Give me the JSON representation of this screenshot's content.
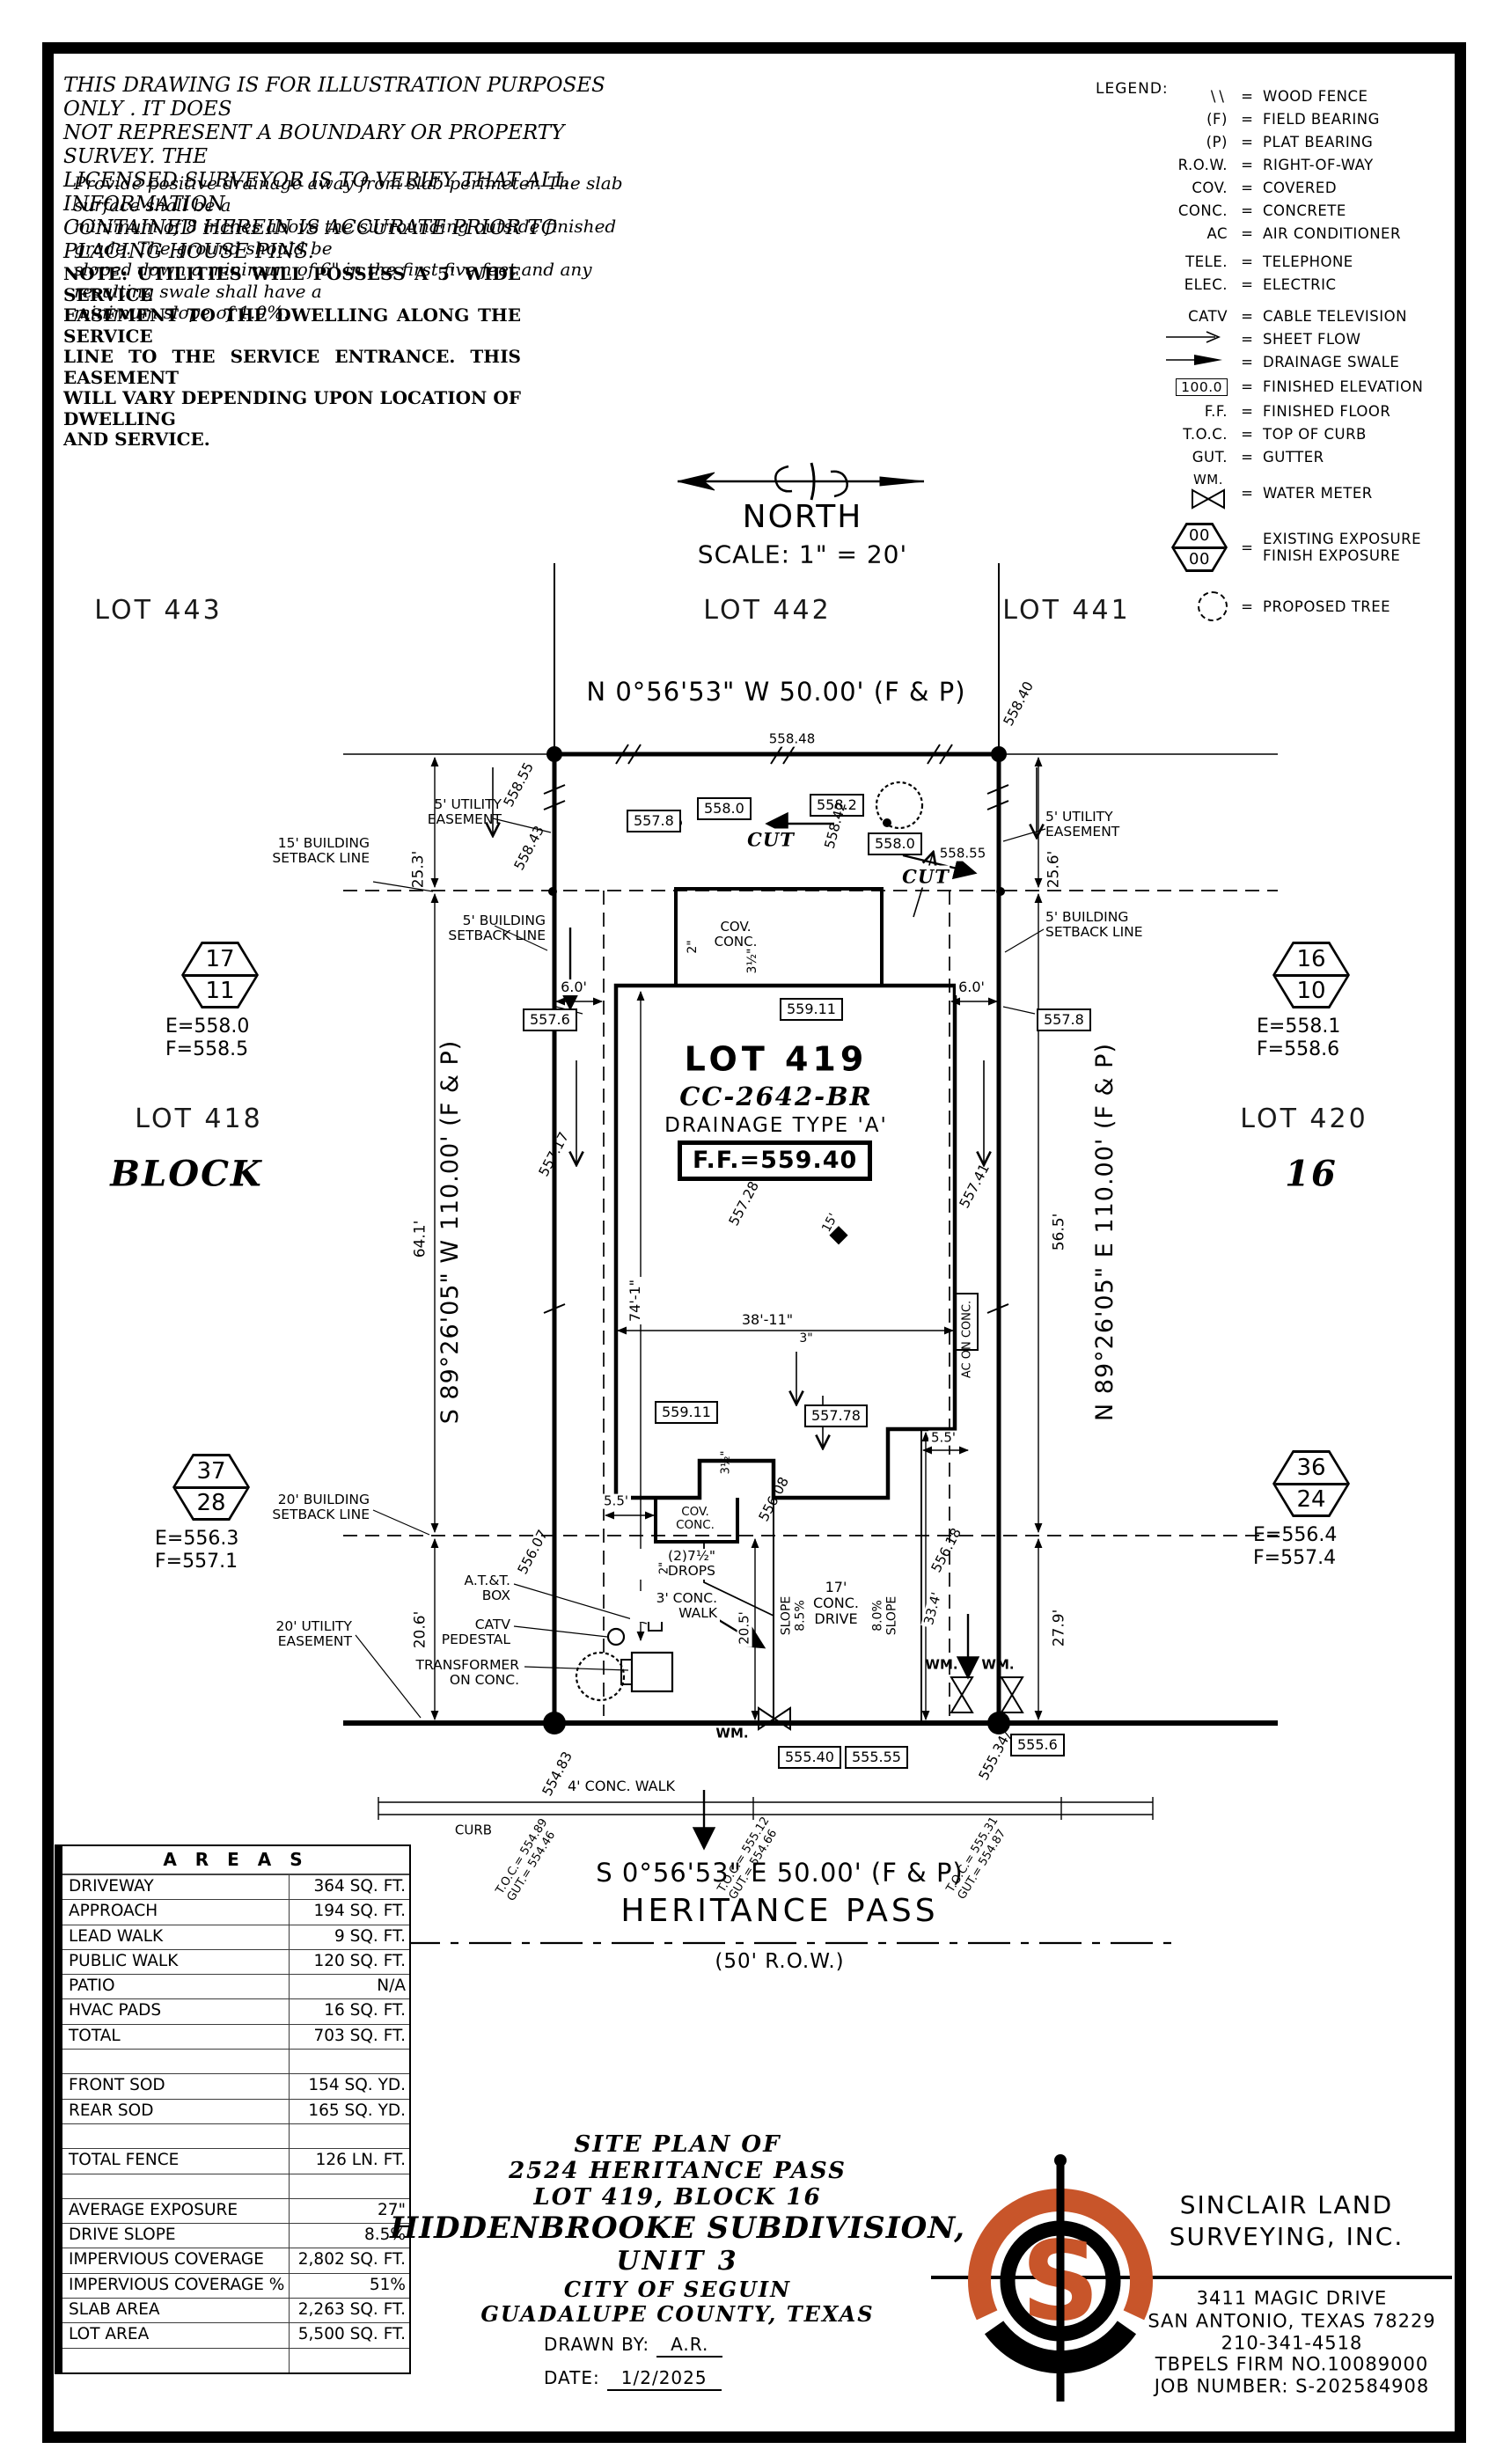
{
  "sheet": {
    "accent": "#c8552a",
    "ink": "#000000"
  },
  "disclaimer": {
    "p1": [
      "THIS DRAWING IS FOR ILLUSTRATION PURPOSES ONLY . IT DOES",
      "NOT REPRESENT A BOUNDARY OR PROPERTY SURVEY. THE",
      "LICENSED SURVEYOR IS TO VERIFY THAT ALL INFORMATION",
      "CONTAINED HEREIN IS ACCURATE PRIOR TO PLACING HOUSE PINS."
    ],
    "p2": [
      "Provide positive drainage away from slab perimeter. The slab surface shall be a",
      "minimum of 8 inches above the surrounding outside finished grade. The ground should be",
      "sloped down a minimum of 6\" in the first five feet and any resulting swale shall have a",
      "minimum slope of 1.0%."
    ],
    "p3": [
      "NOTE: UTILITIES WILL POSSESS A 5' WIDE SERVICE",
      "EASEMENT TO THE DWELLING ALONG THE SERVICE",
      "LINE TO THE SERVICE ENTRANCE. THIS EASEMENT",
      "WILL VARY DEPENDING UPON LOCATION OF DWELLING",
      "AND SERVICE."
    ]
  },
  "legend": {
    "title": "LEGEND:",
    "eq": "=",
    "items": [
      {
        "sym": "\\\\",
        "label": "WOOD FENCE"
      },
      {
        "sym": "(F)",
        "label": "FIELD BEARING"
      },
      {
        "sym": "(P)",
        "label": "PLAT BEARING"
      },
      {
        "sym": "R.O.W.",
        "label": "RIGHT-OF-WAY"
      },
      {
        "sym": "COV.",
        "label": "COVERED"
      },
      {
        "sym": "CONC.",
        "label": "CONCRETE"
      },
      {
        "sym": "AC",
        "label": "AIR CONDITIONER"
      },
      {
        "sym": "TELE.",
        "label": "TELEPHONE"
      },
      {
        "sym": "ELEC.",
        "label": "ELECTRIC"
      },
      {
        "sym": "CATV",
        "label": "CABLE TELEVISION"
      },
      {
        "sym": "sheet-flow-arrow",
        "label": "SHEET FLOW"
      },
      {
        "sym": "drainage-swale-arrow",
        "label": "DRAINAGE SWALE"
      },
      {
        "sym": "100.0",
        "label": "FINISHED ELEVATION"
      },
      {
        "sym": "F.F.",
        "label": "FINISHED FLOOR"
      },
      {
        "sym": "T.O.C.",
        "label": "TOP OF CURB"
      },
      {
        "sym": "GUT.",
        "label": "GUTTER"
      },
      {
        "sym": "WM.",
        "label": "WATER METER"
      },
      {
        "sym": "00 / 00",
        "label": "EXISTING EXPOSURE",
        "label2": "FINISH EXPOSURE",
        "a": "00",
        "b": "00"
      },
      {
        "sym": "proposed-tree",
        "label": "PROPOSED TREE"
      }
    ]
  },
  "north": {
    "label": "NORTH",
    "scale": "SCALE: 1\" = 20'"
  },
  "lots": {
    "l443": "LOT 443",
    "l442": "LOT 442",
    "l441": "LOT 441",
    "l418": "LOT 418",
    "l420": "LOT 420",
    "block_label": "BLOCK",
    "block_num": "16"
  },
  "bearings": {
    "top": "N 0°56'53\" W 50.00' (F & P)",
    "left": "S 89°26'05\" W 110.00' (F & P)",
    "right": "N 89°26'05\" E 110.00' (F & P)",
    "bottom": "S 0°56'53\" E 50.00' (F & P)"
  },
  "street": {
    "name": "HERITANCE PASS",
    "row": "(50' R.O.W.)",
    "walk": "4' CONC. WALK",
    "curb": "CURB"
  },
  "subject": {
    "lot": "LOT 419",
    "plan": "CC-2642-BR",
    "drainage": "DRAINAGE TYPE 'A'",
    "ff": "F.F.=559.40"
  },
  "hex": {
    "h1": {
      "a": "17",
      "b": "11",
      "e": "E=558.0",
      "f": "F=558.5"
    },
    "h2": {
      "a": "16",
      "b": "10",
      "e": "E=558.1",
      "f": "F=558.6"
    },
    "h3": {
      "a": "37",
      "b": "28",
      "e": "E=556.3",
      "f": "F=557.1"
    },
    "h4": {
      "a": "36",
      "b": "24",
      "e": "E=556.4",
      "f": "F=557.4"
    }
  },
  "elev": {
    "r55848": "558.48",
    "r55840": "558.40",
    "r55855a": "558.55",
    "r55843": "558.43",
    "r55842": "558.42",
    "r55855b": "558.55",
    "b5578": "557.8",
    "b5580a": "558.0",
    "b5582": "558.2",
    "b5580b": "558.0",
    "b5576": "557.6",
    "b5578r": "557.8",
    "b55911a": "559.11",
    "b55911b": "559.11",
    "b55778": "557.78",
    "r55717": "557.17",
    "r55728": "557.28",
    "r55741": "557.41",
    "r55607": "556.07",
    "r55608": "556.08",
    "r55618": "556.18",
    "b55540": "555.40",
    "b55555": "555.55",
    "b5556": "555.6",
    "r55534": "555.34",
    "r55483": "554.83"
  },
  "toc": {
    "t1": {
      "l1": "T.O.C.= 554.89",
      "l2": "GUT.= 554.46"
    },
    "t2": {
      "l1": "T.O.C.= 555.12",
      "l2": "GUT.= 554.66"
    },
    "t3": {
      "l1": "T.O.C.= 555.31",
      "l2": "GUT.= 554.87"
    }
  },
  "callouts": {
    "ue5": [
      "5' UTILITY",
      "EASEMENT"
    ],
    "bsl15": [
      "15' BUILDING",
      "SETBACK LINE"
    ],
    "bsl5": [
      "5' BUILDING",
      "SETBACK LINE"
    ],
    "bsl20": [
      "20' BUILDING",
      "SETBACK LINE"
    ],
    "ue20": [
      "20' UTILITY",
      "EASEMENT"
    ],
    "covconc": [
      "COV.",
      "CONC."
    ],
    "att": [
      "A.T.&T.",
      "BOX"
    ],
    "catv": [
      "CATV",
      "PEDESTAL"
    ],
    "transformer": [
      "TRANSFORMER",
      "ON CONC."
    ],
    "drops": [
      "(2)7½\"",
      "DROPS"
    ],
    "walk3": [
      "3' CONC.",
      "WALK"
    ],
    "drive17": [
      "17'",
      "CONC.",
      "DRIVE"
    ],
    "slope1": [
      "SLOPE",
      "8.5%"
    ],
    "slope2": [
      "8.0%",
      "SLOPE"
    ],
    "ac": "AC ON CONC.",
    "cut": "CUT",
    "wm": "WM."
  },
  "dims": {
    "d253": "25.3'",
    "d256": "25.6'",
    "d641": "64.1'",
    "d565": "56.5'",
    "d206": "20.6'",
    "d279": "27.9'",
    "d60": "6.0'",
    "d55": "5.5'",
    "d741": "74'-1\"",
    "d3811": "38'-11\"",
    "d205": "20.5'",
    "d334": "33.4'",
    "d15": "15'",
    "d2": "2\"",
    "d35": "3½\"",
    "d3": "3\""
  },
  "areas": {
    "title": "A R E A S",
    "rows": [
      {
        "label": "DRIVEWAY",
        "value": "364 SQ. FT."
      },
      {
        "label": "APPROACH",
        "value": "194 SQ. FT."
      },
      {
        "label": "LEAD WALK",
        "value": "9 SQ. FT."
      },
      {
        "label": "PUBLIC WALK",
        "value": "120 SQ. FT."
      },
      {
        "label": "PATIO",
        "value": "N/A"
      },
      {
        "label": "HVAC PADS",
        "value": "16 SQ. FT."
      },
      {
        "label": "TOTAL",
        "value": "703 SQ. FT."
      },
      {
        "label": "",
        "value": ""
      },
      {
        "label": "FRONT SOD",
        "value": "154 SQ. YD."
      },
      {
        "label": "REAR SOD",
        "value": "165 SQ. YD."
      },
      {
        "label": "",
        "value": ""
      },
      {
        "label": "TOTAL FENCE",
        "value": "126 LN. FT."
      },
      {
        "label": "",
        "value": ""
      },
      {
        "label": "AVERAGE EXPOSURE",
        "value": "27\""
      },
      {
        "label": "DRIVE SLOPE",
        "value": "8.5%"
      },
      {
        "label": "IMPERVIOUS COVERAGE",
        "value": "2,802 SQ. FT."
      },
      {
        "label": "IMPERVIOUS COVERAGE %",
        "value": "51%"
      },
      {
        "label": "SLAB AREA",
        "value": "2,263 SQ. FT."
      },
      {
        "label": "LOT AREA",
        "value": "5,500 SQ. FT."
      },
      {
        "label": "",
        "value": ""
      }
    ]
  },
  "titleblock": {
    "l1": "SITE PLAN OF",
    "l2": "2524 HERITANCE PASS",
    "l3": "LOT 419, BLOCK 16",
    "l4": "HIDDENBROOKE SUBDIVISION,",
    "l5": "UNIT 3",
    "l6": "CITY OF SEGUIN",
    "l7": "GUADALUPE COUNTY, TEXAS",
    "drawn_label": "DRAWN BY:",
    "drawn": "A.R.",
    "date_label": "DATE:",
    "date": "1/2/2025"
  },
  "firm": {
    "logo_letter": "S",
    "n1": "SINCLAIR LAND",
    "n2": "SURVEYING, INC.",
    "a1": "3411 MAGIC DRIVE",
    "a2": "SAN ANTONIO, TEXAS 78229",
    "a3": "210-341-4518",
    "a4": "TBPELS FIRM NO.10089000",
    "a5": "JOB NUMBER: S-202584908"
  }
}
